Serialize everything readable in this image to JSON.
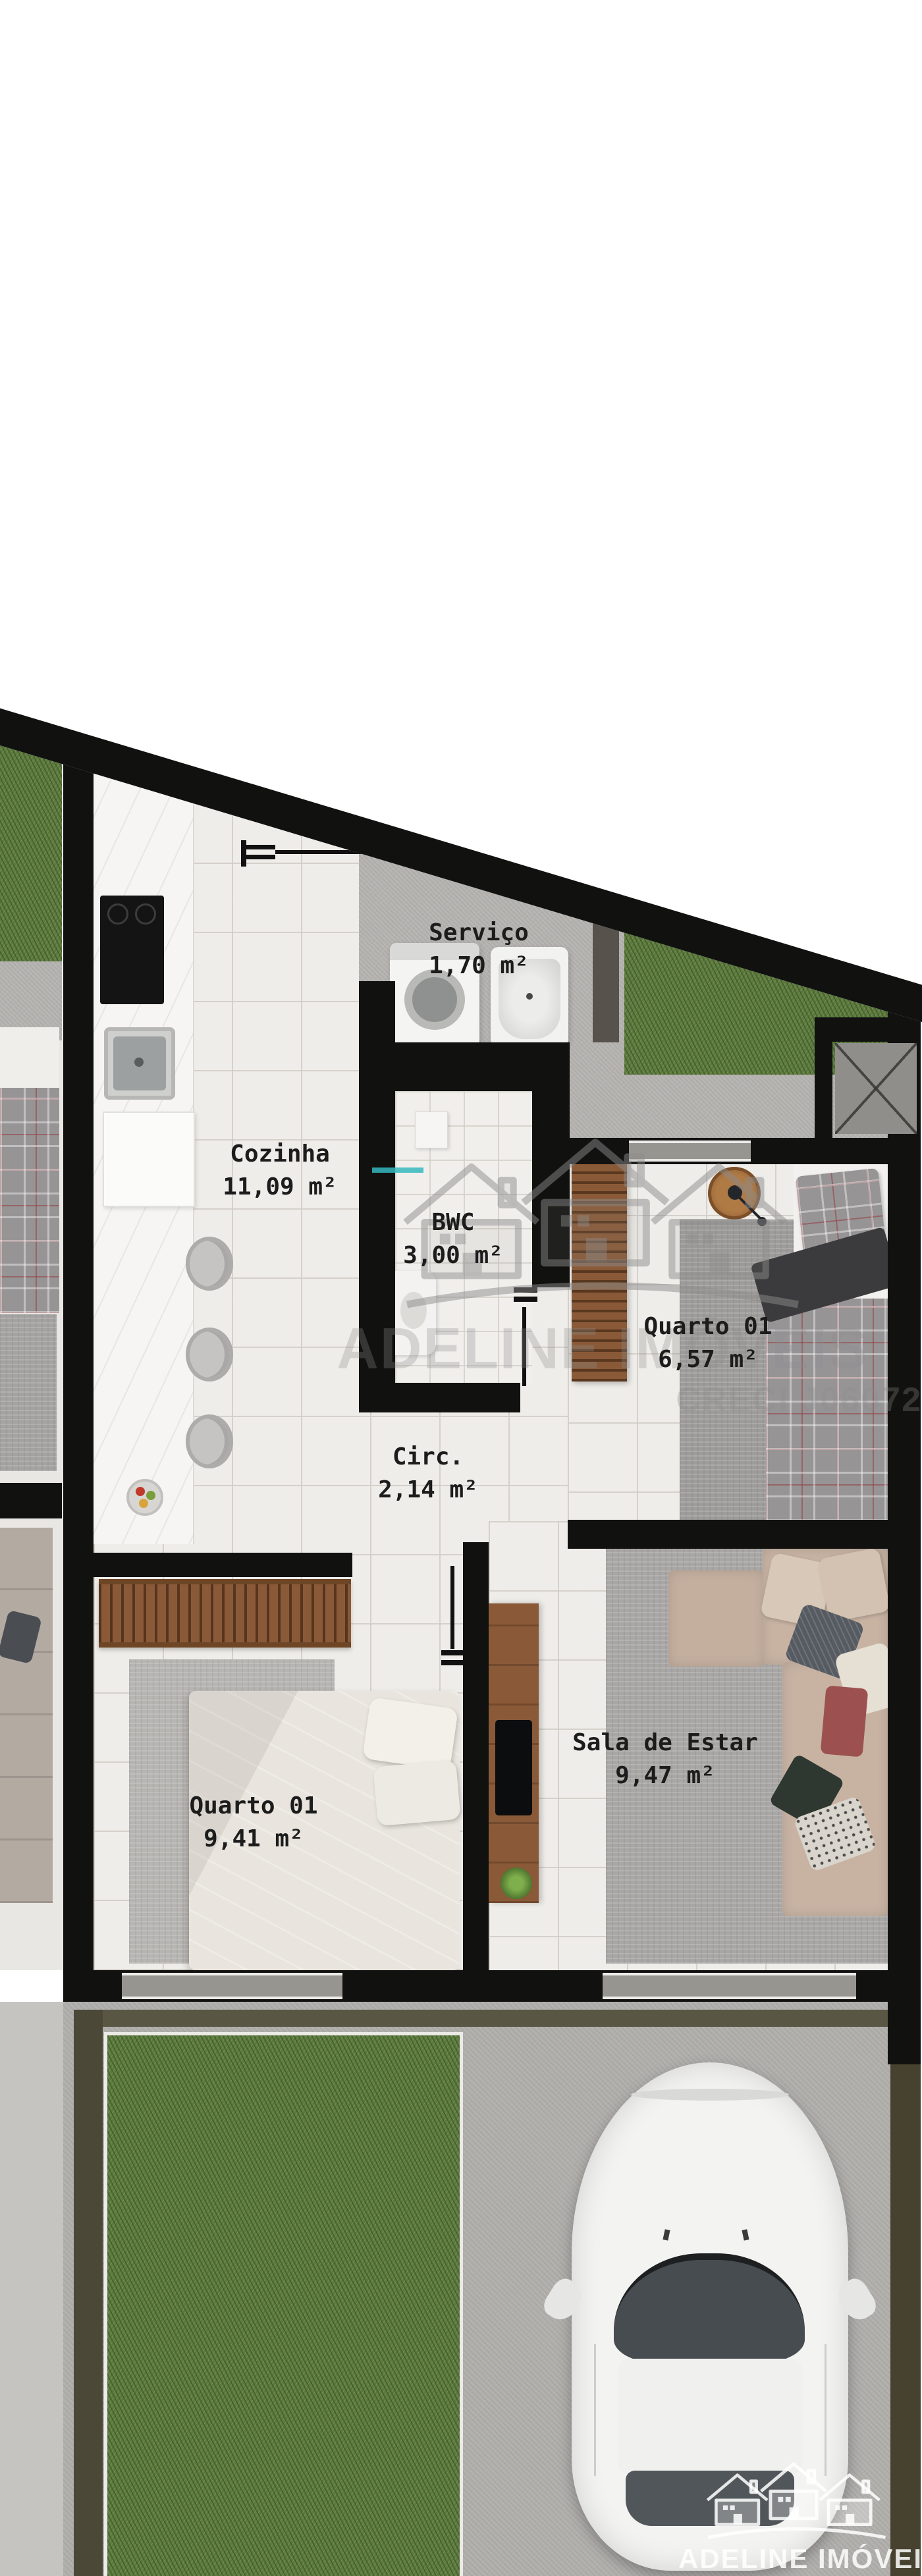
{
  "document": {
    "type": "architectural floor plan render (top view)"
  },
  "rooms": {
    "servico": {
      "name": "Serviço",
      "area": "1,70 m²"
    },
    "cozinha": {
      "name": "Cozinha",
      "area": "11,09 m²"
    },
    "bwc": {
      "name": "BWC",
      "area": "3,00 m²"
    },
    "quarto_direita": {
      "name": "Quarto 01",
      "area": "6,57 m²"
    },
    "circulacao": {
      "name": "Circ.",
      "area": "2,14 m²"
    },
    "quarto_esquerda": {
      "name": "Quarto 01",
      "area": "9,41 m²"
    },
    "sala": {
      "name": "Sala de Estar",
      "area": "9,47 m²"
    }
  },
  "watermark": {
    "company": "ADELINE IMÓVEIS",
    "license": "CRECI J06072"
  },
  "colors": {
    "wall": "#111110",
    "grass": "#5d7b3f",
    "concrete": "#b7b5b2",
    "tile": "#efede9",
    "wood": "#8a5a38",
    "glass_teal": "#35b8c0",
    "car_body": "#f3f3f2",
    "watermark_text": "#ffffff"
  }
}
